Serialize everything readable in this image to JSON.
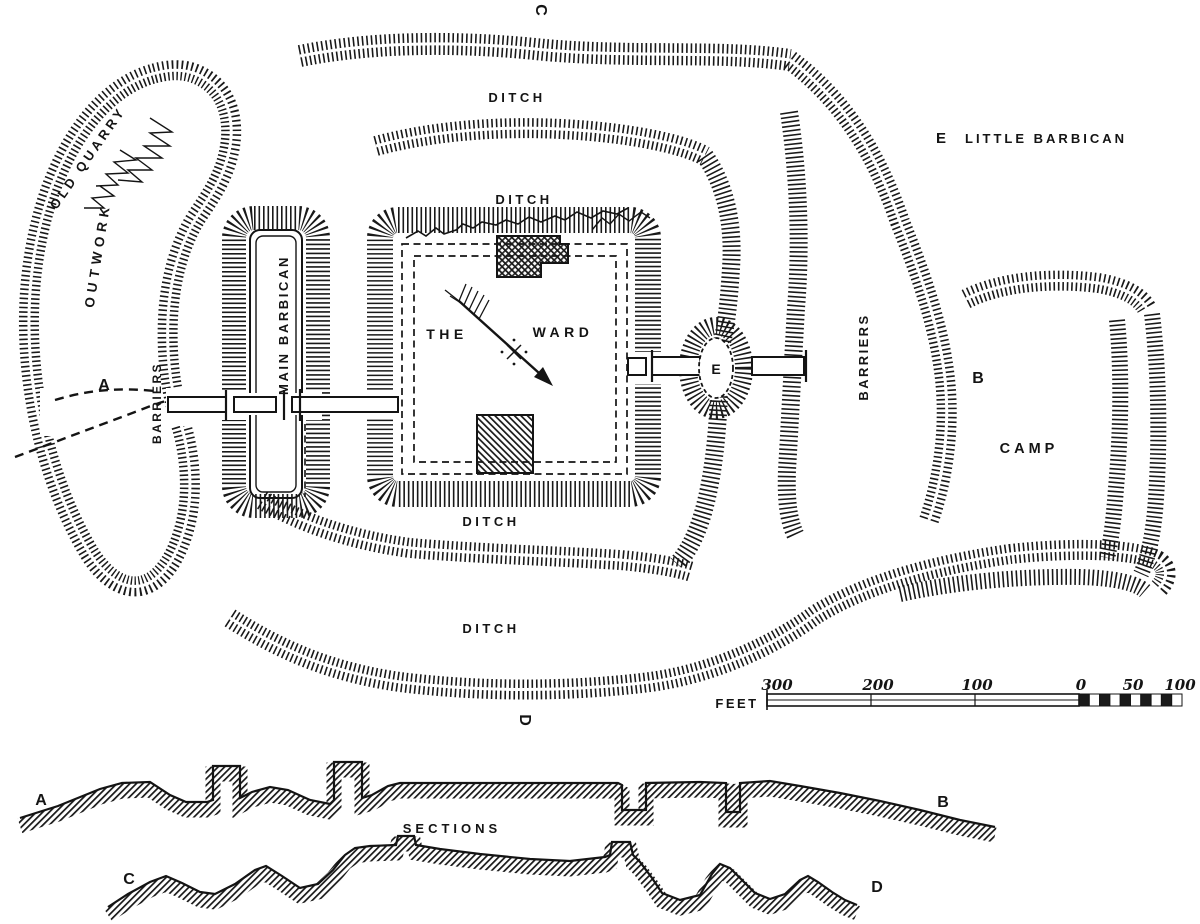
{
  "figure": {
    "background": "#ffffff",
    "ink": "#141414"
  },
  "plan": {
    "labels": {
      "point_c": "C",
      "point_d": "D",
      "point_a": "A",
      "point_b": "B",
      "old_quarry": "OLD QUARRY",
      "outwork": "OUTWORK",
      "barriers_west": "BARRIERS",
      "main_barbican": "MAIN BARBICAN",
      "the": "THE",
      "ward": "WARD",
      "e_mound": "E",
      "barriers_east": "BARRIERS",
      "camp": "CAMP",
      "ditch_north_outer": "DITCH",
      "ditch_north_inner": "DITCH",
      "ditch_south_inner": "DITCH",
      "ditch_south_outer": "DITCH"
    },
    "legend": {
      "key": "E",
      "label": "LITTLE BARBICAN"
    }
  },
  "scale_bar": {
    "unit": "FEET",
    "ticks": [
      "300",
      "200",
      "100",
      "0",
      "50",
      "100"
    ]
  },
  "sections": {
    "title": "SECTIONS",
    "ab": {
      "start": "A",
      "end": "B"
    },
    "cd": {
      "start": "C",
      "end": "D"
    }
  }
}
